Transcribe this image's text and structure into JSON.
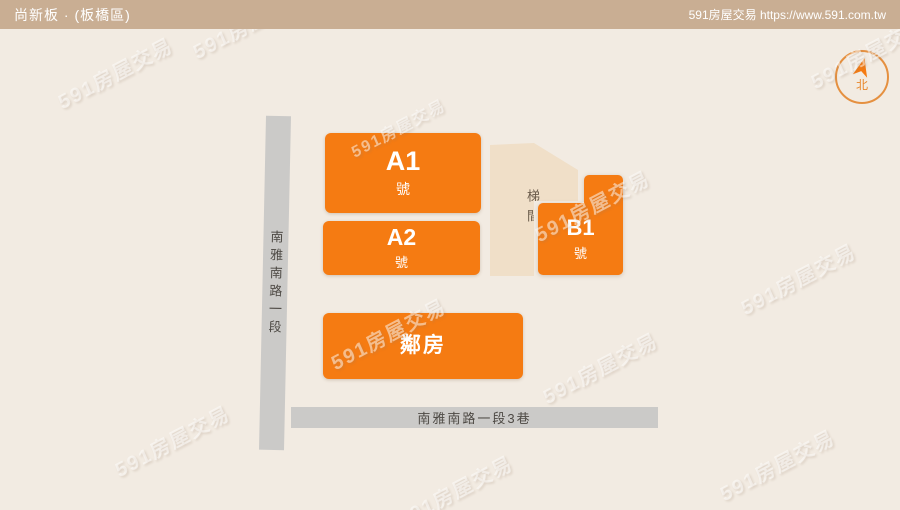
{
  "header": {
    "title": "尚新板 · (板橋區)",
    "site": "591房屋交易 https://www.591.com.tw"
  },
  "map": {
    "blocks": {
      "a1": {
        "label": "A1",
        "sub": "號"
      },
      "a2": {
        "label": "A2",
        "sub": "號"
      },
      "b1": {
        "label": "B1",
        "sub": "號"
      },
      "neighbor": {
        "label": "鄰房"
      }
    },
    "stairwell_label": "梯間",
    "roads": {
      "vertical": "南雅南路一段",
      "horizontal": "南雅南路一段3巷"
    }
  },
  "compass": {
    "north_label": "北"
  },
  "watermark": {
    "text": "591房屋交易"
  },
  "colors": {
    "brand_orange": "#F57B12",
    "header_tan": "#C9AE93",
    "page_beige": "#F2EBE2",
    "stairwell_beige": "#F0DFC8",
    "road_gray": "#CBCAC8"
  }
}
